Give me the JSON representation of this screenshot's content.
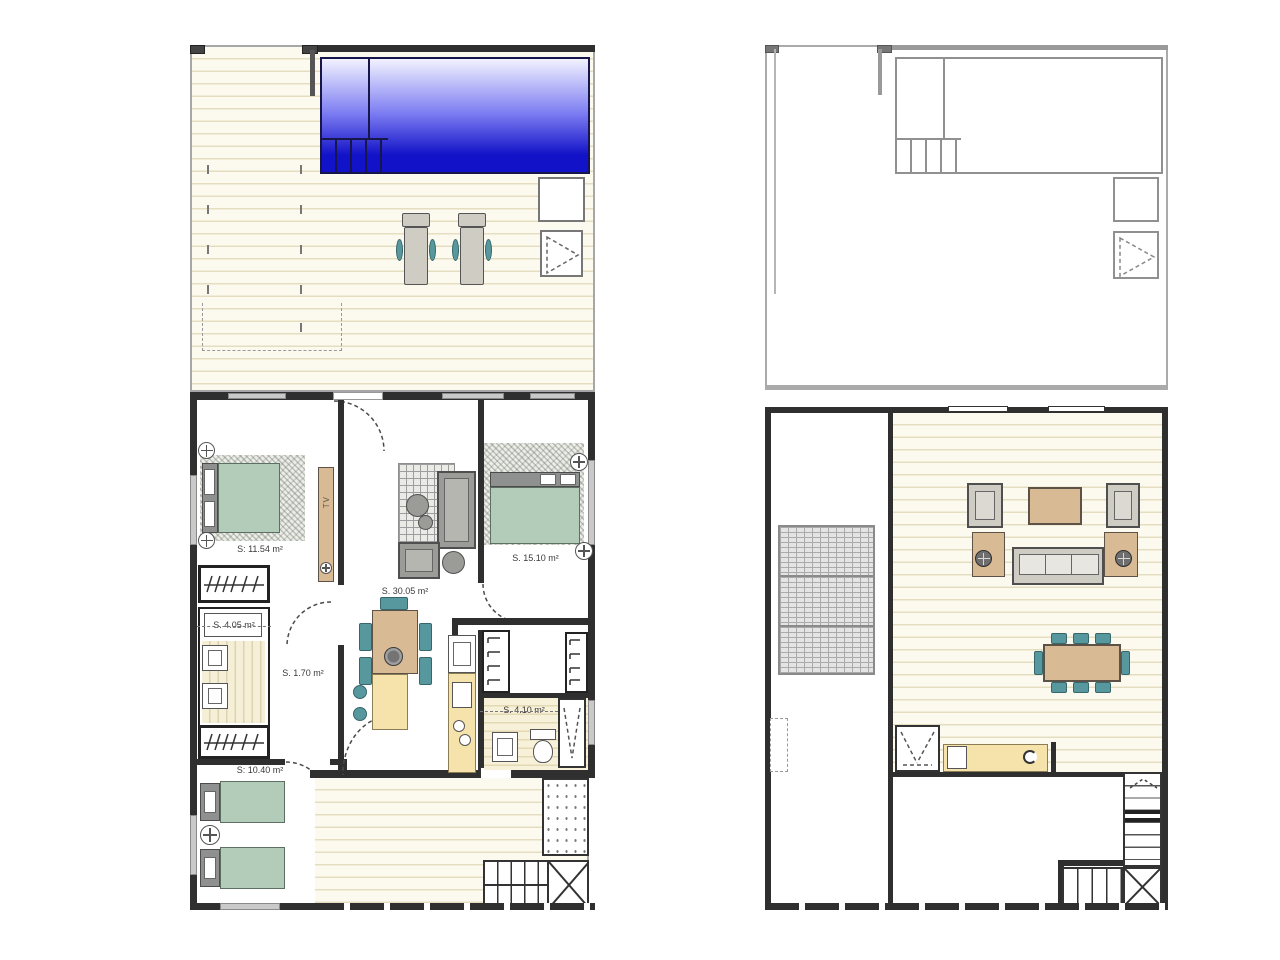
{
  "colors": {
    "background": "#ffffff",
    "wall_dark": "#2f2f2f",
    "wall_gray": "#9a9a9a",
    "deck_base": "#fcfaef",
    "deck_line": "#e4ddc0",
    "pool_top": "#f2f2ff",
    "pool_mid": "#7d7df2",
    "pool_bottom": "#1212c8",
    "bed_green": "#b3ccb9",
    "chair_teal": "#57989e",
    "wood_tan": "#d8ba94",
    "counter_yellow": "#f6e2ab",
    "furniture_gray": "#9b9b98"
  },
  "plans": {
    "ground_floor": {
      "rooms": {
        "bedroom1": {
          "label": "S: 11.54 m²"
        },
        "bedroom2": {
          "label": "S. 15.10 m²"
        },
        "living": {
          "label": "S. 30.05 m²"
        },
        "bath1": {
          "label": "S. 4.05 m²"
        },
        "hall": {
          "label": "S. 1.70 m²"
        },
        "bath2": {
          "label": "S. 4.10 m²"
        },
        "bedroom3": {
          "label": "S: 10.40 m²"
        }
      },
      "tv_label": "TV"
    },
    "roof_plan": {}
  }
}
